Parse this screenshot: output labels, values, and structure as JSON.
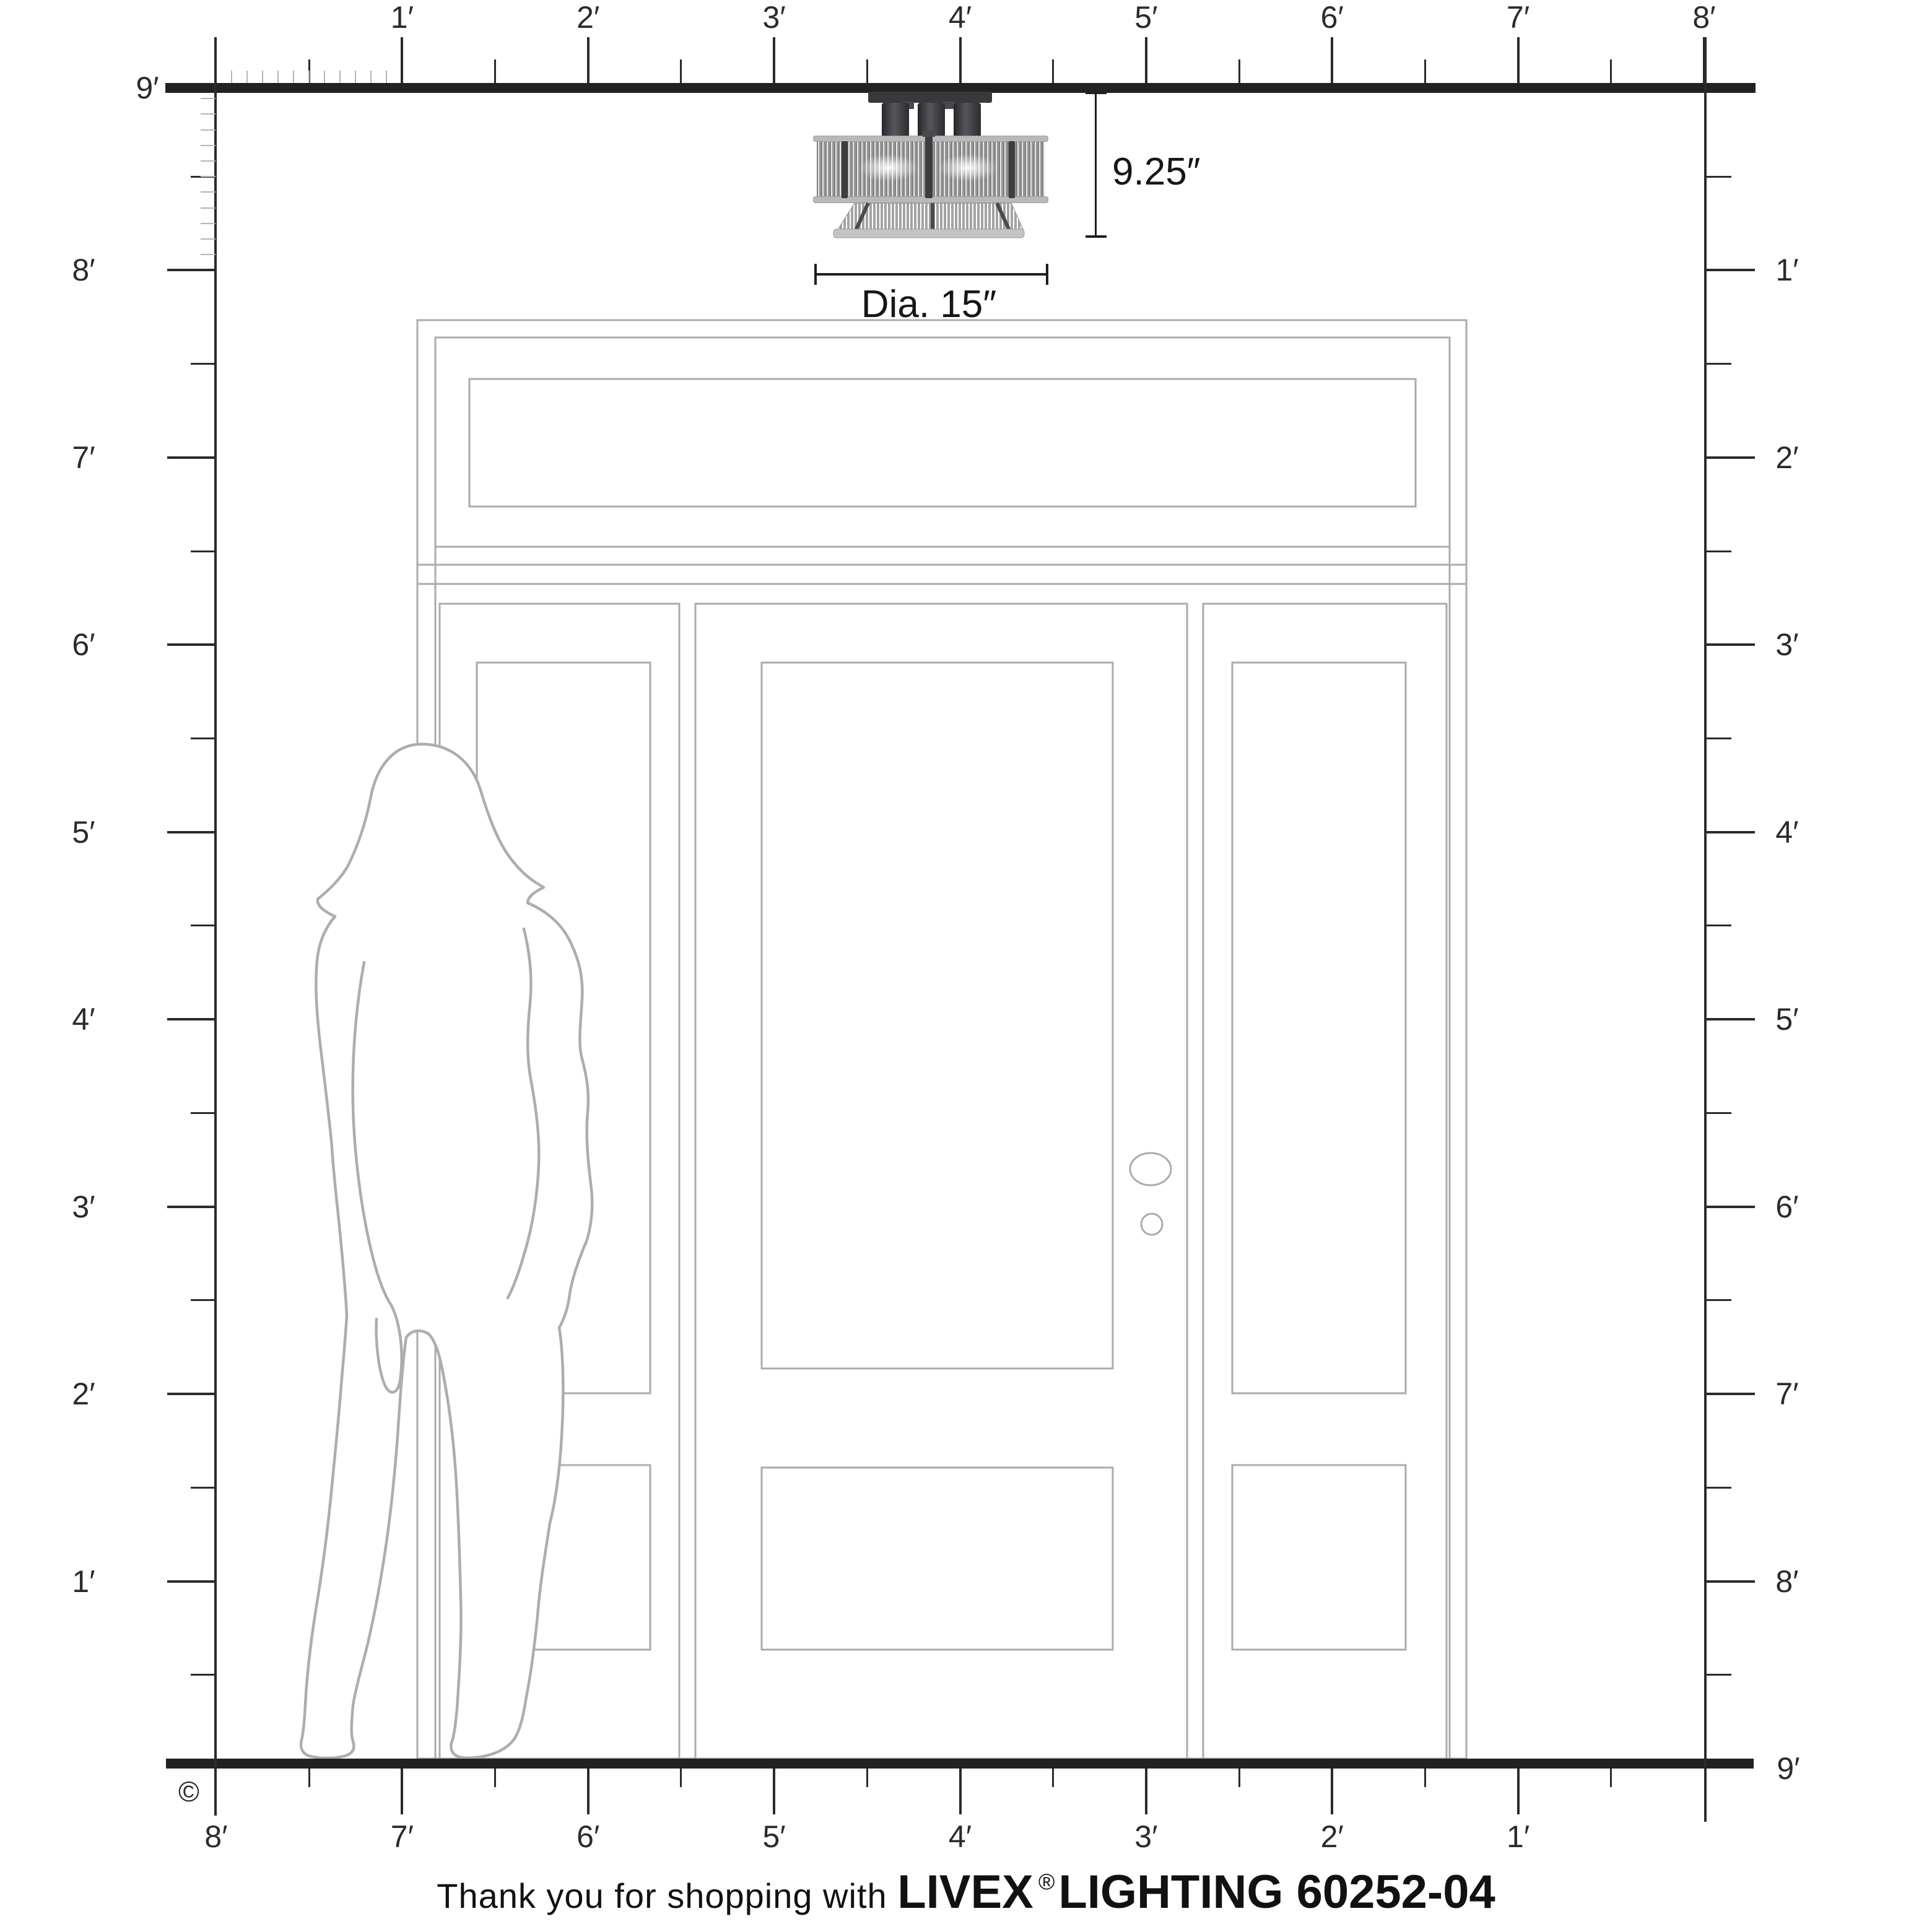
{
  "rulers": {
    "top_labels": [
      "1′",
      "2′",
      "3′",
      "4′",
      "5′",
      "6′",
      "7′",
      "8′"
    ],
    "left_top_label": "9′",
    "left_labels": [
      "8′",
      "7′",
      "6′",
      "5′",
      "4′",
      "3′",
      "2′",
      "1′"
    ],
    "right_labels": [
      "1′",
      "2′",
      "3′",
      "4′",
      "5′",
      "6′",
      "7′",
      "8′"
    ],
    "right_bottom_label": "9′",
    "bottom_labels": [
      "8′",
      "7′",
      "6′",
      "5′",
      "4′",
      "3′",
      "2′",
      "1′"
    ]
  },
  "dimensions": {
    "height_label": "9.25″",
    "diameter_label": "Dia. 15″"
  },
  "footer": {
    "prefix": "Thank you for shopping with",
    "brand": "LIVEX",
    "registered_mark": "®",
    "suffix": "LIGHTING 60252-04"
  },
  "copyright_symbol": "©",
  "colors": {
    "ink": "#242122",
    "drawing_gray": "#ababab",
    "fixture_dark": "#39393c",
    "shade_gray": "#b9b9b9"
  }
}
